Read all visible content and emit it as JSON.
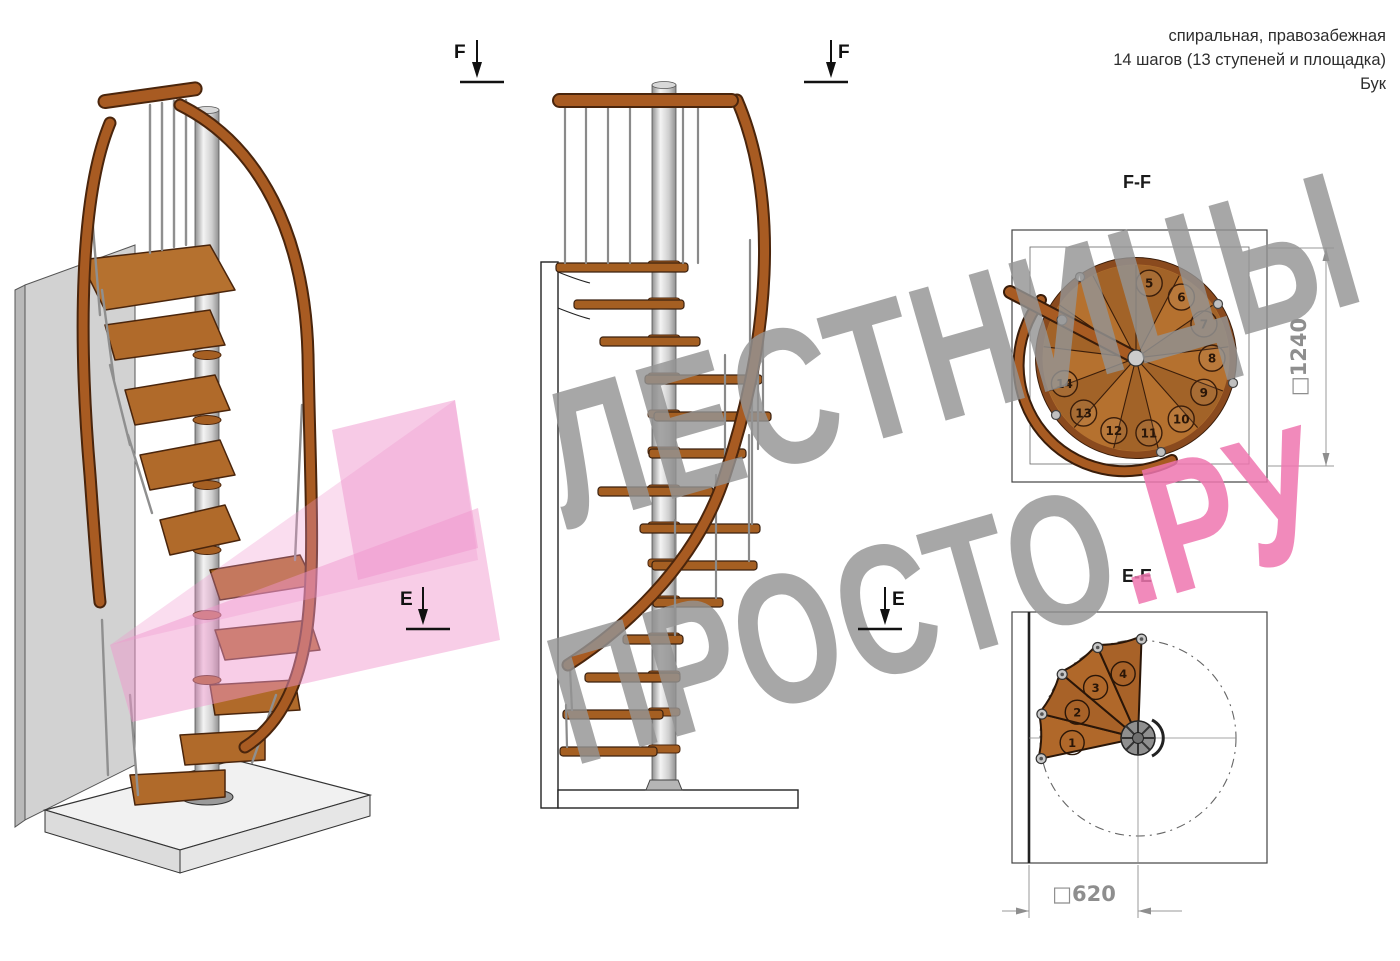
{
  "header": {
    "line1": "спиральная, правозабежная",
    "line2": "14 шагов (13 ступеней и площадка)",
    "line3": "Бук"
  },
  "markers": {
    "f_left": "F",
    "f_right": "F",
    "e_left": "E",
    "e_right": "E"
  },
  "views": {
    "ff": {
      "title": "F-F",
      "dimension": "□1240",
      "steps": [
        "5",
        "6",
        "7",
        "8",
        "9",
        "10",
        "11",
        "12",
        "13",
        "14"
      ]
    },
    "ee": {
      "title": "E-E",
      "dimension": "□620",
      "steps": [
        "1",
        "2",
        "3",
        "4"
      ]
    }
  },
  "watermark": {
    "line1": "ЛЕСТНИЦЫ",
    "line2_gray": "ПРОСТО",
    "line2_pink": ".РУ"
  },
  "colors": {
    "wood": "#a85b22",
    "wood_dark": "#4a250c",
    "wood_light": "#b5712f",
    "metal_light": "#e8e8e8",
    "metal_mid": "#9a9a9a",
    "wall_gray": "#d2d2d2",
    "watermark_gray": "#949494",
    "watermark_pink": "#ee76af",
    "arrow_pink": "#f096cb",
    "dimension_gray": "#8e8e8e"
  }
}
